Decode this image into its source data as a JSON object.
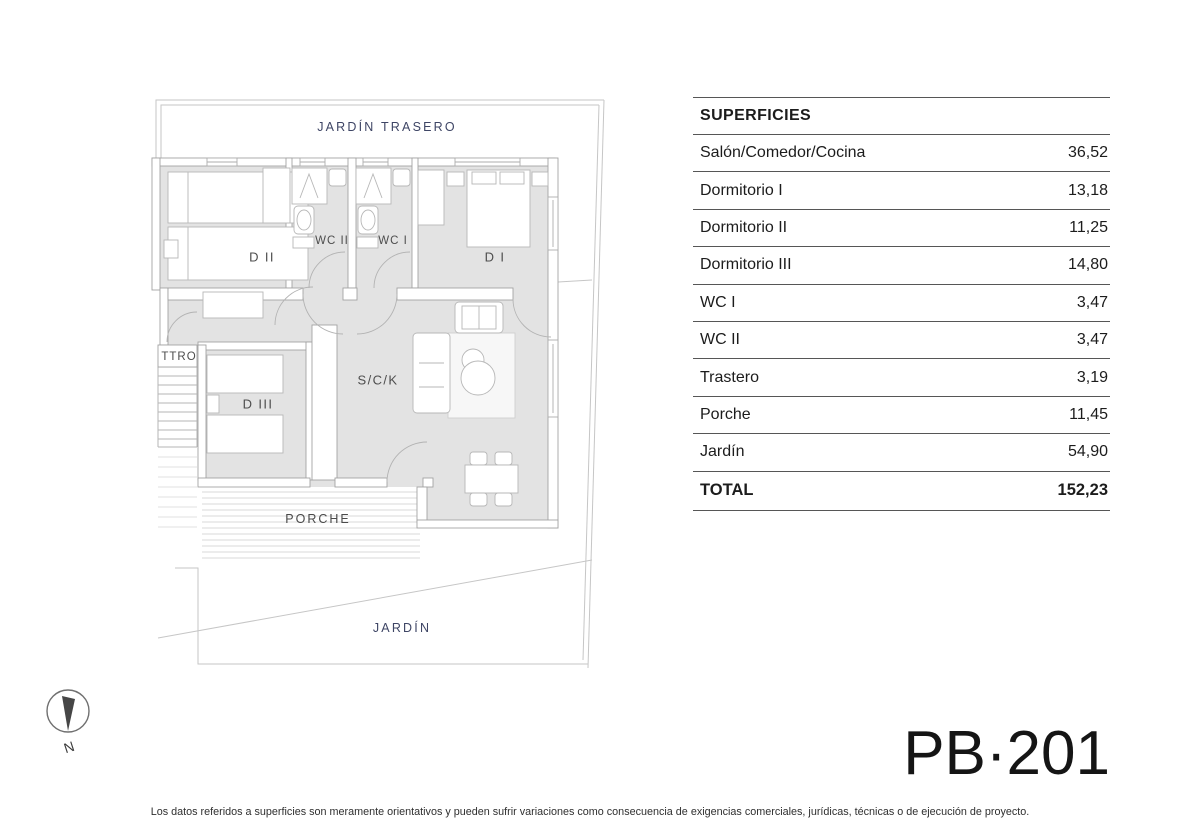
{
  "colors": {
    "label_navy": "#3e4565",
    "plan_floor_fill": "#e3e3e3",
    "plan_wall_line": "#a3a3a3",
    "table_line": "#565656"
  },
  "plan": {
    "labels": {
      "jardin_trasero": "JARDÍN TRASERO",
      "d2": "D II",
      "wc2": "WC II",
      "wc1": "WC I",
      "d1": "D I",
      "ttro": "TTRO",
      "d3": "D III",
      "sck": "S/C/K",
      "porche": "PORCHE",
      "jardin": "JARDÍN"
    }
  },
  "table": {
    "header": "SUPERFICIES",
    "rows": [
      {
        "label": "Salón/Comedor/Cocina",
        "value": "36,52"
      },
      {
        "label": "Dormitorio I",
        "value": "13,18"
      },
      {
        "label": "Dormitorio II",
        "value": "11,25"
      },
      {
        "label": "Dormitorio III",
        "value": "14,80"
      },
      {
        "label": "WC I",
        "value": "3,47"
      },
      {
        "label": "WC II",
        "value": "3,47"
      },
      {
        "label": "Trastero",
        "value": "3,19"
      },
      {
        "label": "Porche",
        "value": "11,45"
      },
      {
        "label": "Jardín",
        "value": "54,90"
      }
    ],
    "total": {
      "label": "TOTAL",
      "value": "152,23"
    }
  },
  "compass": {
    "north_label": "N"
  },
  "unit_code": "PB·201",
  "disclaimer": "Los datos referidos a superficies son meramente orientativos y pueden sufrir variaciones como consecuencia de exigencias comerciales, jurídicas, técnicas o de ejecución de proyecto."
}
